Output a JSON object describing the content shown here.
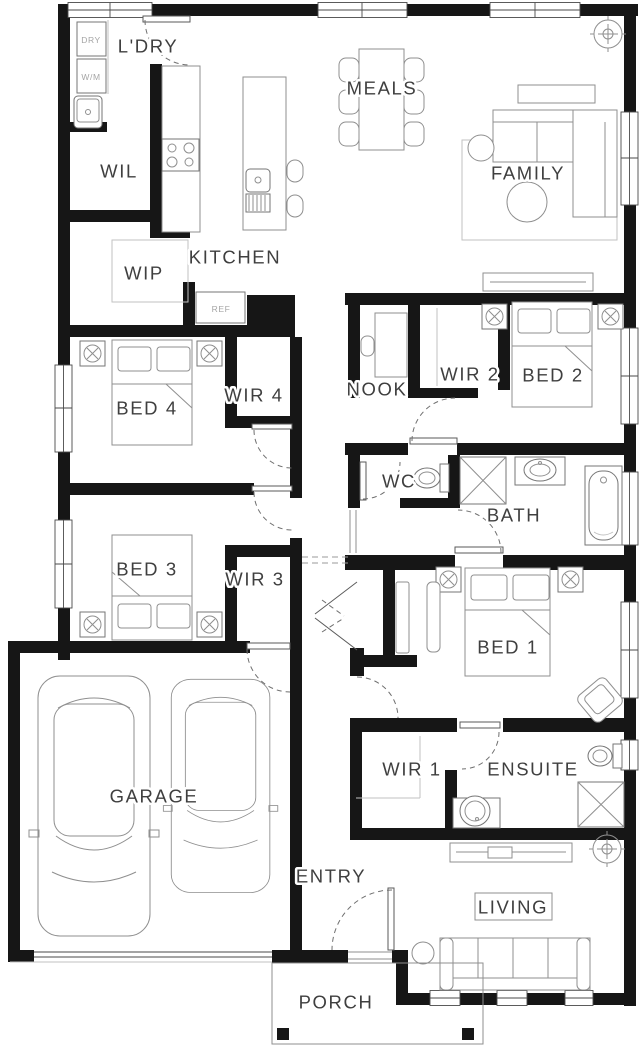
{
  "plan": {
    "type": "residential-floor-plan",
    "rooms": [
      {
        "id": "ldry",
        "label": "L'DRY",
        "x": 148,
        "y": 46
      },
      {
        "id": "wil",
        "label": "WIL",
        "x": 119,
        "y": 171
      },
      {
        "id": "meals",
        "label": "MEALS",
        "x": 382,
        "y": 88
      },
      {
        "id": "family",
        "label": "FAMILY",
        "x": 528,
        "y": 173
      },
      {
        "id": "kitchen",
        "label": "KITCHEN",
        "x": 235,
        "y": 257
      },
      {
        "id": "wip",
        "label": "WIP",
        "x": 144,
        "y": 273
      },
      {
        "id": "nook",
        "label": "NOOK",
        "x": 377,
        "y": 389
      },
      {
        "id": "wir2",
        "label": "WIR 2",
        "x": 470,
        "y": 374
      },
      {
        "id": "bed2",
        "label": "BED 2",
        "x": 553,
        "y": 375
      },
      {
        "id": "bed4",
        "label": "BED 4",
        "x": 147,
        "y": 408
      },
      {
        "id": "wir4",
        "label": "WIR 4",
        "x": 254,
        "y": 395
      },
      {
        "id": "wc",
        "label": "WC",
        "x": 399,
        "y": 481
      },
      {
        "id": "bath",
        "label": "BATH",
        "x": 514,
        "y": 515
      },
      {
        "id": "bed3",
        "label": "BED 3",
        "x": 147,
        "y": 569
      },
      {
        "id": "wir3",
        "label": "WIR 3",
        "x": 255,
        "y": 579
      },
      {
        "id": "bed1",
        "label": "BED 1",
        "x": 508,
        "y": 647
      },
      {
        "id": "garage",
        "label": "GARAGE",
        "x": 154,
        "y": 796
      },
      {
        "id": "wir1",
        "label": "WIR 1",
        "x": 412,
        "y": 769
      },
      {
        "id": "ensuite",
        "label": "ENSUITE",
        "x": 533,
        "y": 769
      },
      {
        "id": "entry",
        "label": "ENTRY",
        "x": 331,
        "y": 876
      },
      {
        "id": "living",
        "label": "LIVING",
        "x": 513,
        "y": 907
      },
      {
        "id": "porch",
        "label": "PORCH",
        "x": 336,
        "y": 1002
      }
    ],
    "appliances": [
      {
        "id": "dryer",
        "label": "DRY",
        "x": 91,
        "y": 40
      },
      {
        "id": "washer",
        "label": "W/M",
        "x": 91,
        "y": 77
      },
      {
        "id": "fridge",
        "label": "REF",
        "x": 221,
        "y": 309
      }
    ],
    "colors": {
      "wall": "#161616",
      "furniture_line": "#8f8f8f",
      "label": "#3f3f3f",
      "small_label": "#a5a5a5"
    }
  }
}
